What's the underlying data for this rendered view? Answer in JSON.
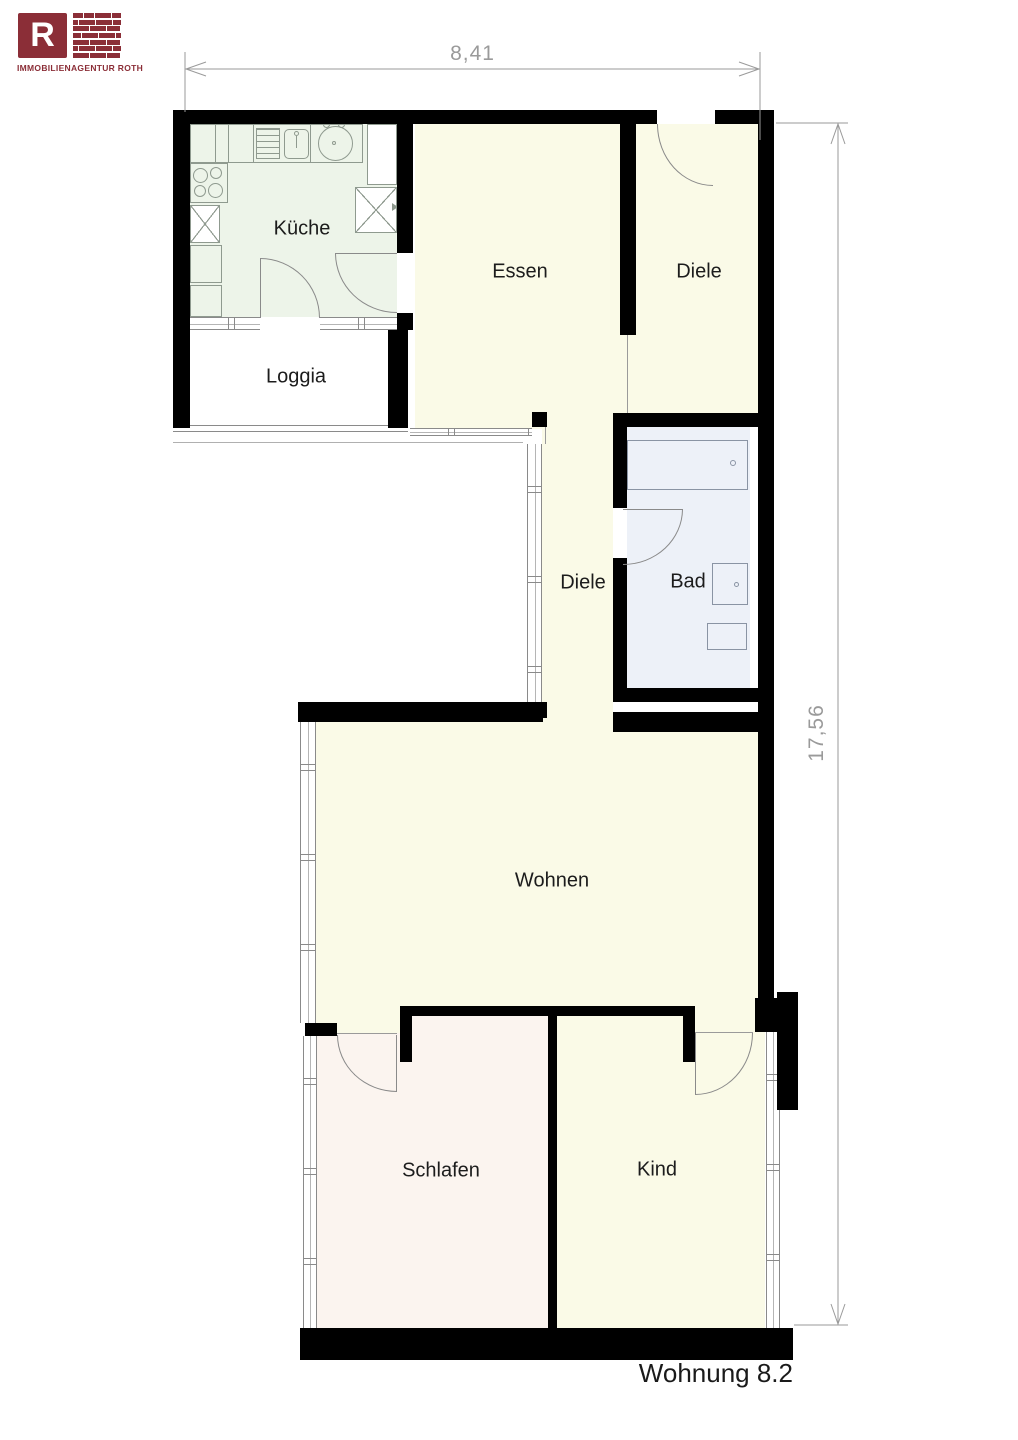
{
  "logo": {
    "letter": "R",
    "company": "IMMOBILIENAGENTUR  ROTH"
  },
  "title": "Wohnung 8.2",
  "dimensions": {
    "width_label": "8,41",
    "height_label": "17,56"
  },
  "rooms": {
    "kueche": {
      "label": "Küche"
    },
    "essen": {
      "label": "Essen"
    },
    "diele_top": {
      "label": "Diele"
    },
    "loggia": {
      "label": "Loggia"
    },
    "diele_mid": {
      "label": "Diele"
    },
    "bad": {
      "label": "Bad"
    },
    "wohnen": {
      "label": "Wohnen"
    },
    "schlafen": {
      "label": "Schlafen"
    },
    "kind": {
      "label": "Kind"
    }
  },
  "colors": {
    "wall": "#000000",
    "cream": "#fafae7",
    "kueche": "#edf4e9",
    "bad": "#edf1f8",
    "schlafen": "#fbf4ef",
    "loggia": "#ffffff",
    "accent": "#8b2e37",
    "dimension": "#9a9a9a",
    "outline_kitchen": "#8f9a8f",
    "outline_bad": "#8a94a4"
  }
}
